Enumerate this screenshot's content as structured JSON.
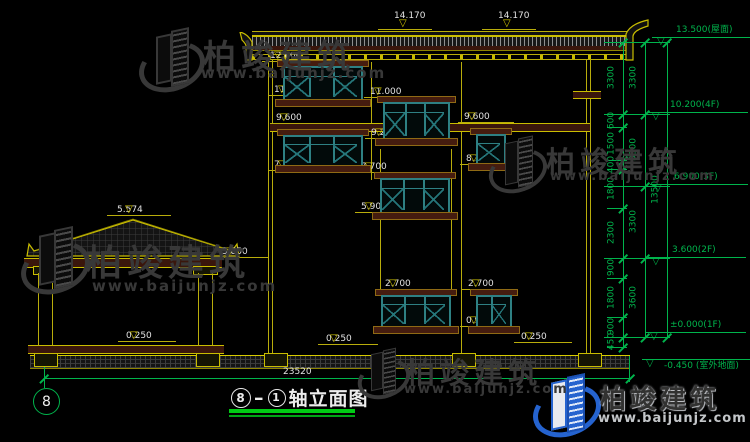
{
  "colors": {
    "background": "#000000",
    "structure_yellow": "#c9bd00",
    "dimension_green": "#00b44c",
    "label_white": "#e2e2e2",
    "window_teal": "#2e8083",
    "board_maroon": "#451c0f",
    "watermark_gray": "#383838",
    "logo_blue": "#2563cf",
    "underline_green": "#00cc14"
  },
  "title": {
    "axis_a": "8",
    "separator": "–",
    "axis_b": "1",
    "name": "轴立面图"
  },
  "axis_bubble": "8",
  "ground_dimension": "23520",
  "facade_markers": [
    {
      "text": "14.170"
    },
    {
      "text": "14.170"
    },
    {
      "text": "12.600"
    },
    {
      "text": "11.100"
    },
    {
      "text": "11.000"
    },
    {
      "text": "9.600"
    },
    {
      "text": "9.200"
    },
    {
      "text": "9.600"
    },
    {
      "text": "8.100"
    },
    {
      "text": "7.800"
    },
    {
      "text": "7.700"
    },
    {
      "text": "5.900"
    },
    {
      "text": "5.574"
    },
    {
      "text": "3.850"
    },
    {
      "text": "2.700"
    },
    {
      "text": "0.900"
    },
    {
      "text": "2.700"
    },
    {
      "text": "0.900"
    },
    {
      "text": "0.250"
    },
    {
      "text": "0.250"
    },
    {
      "text": "0.250"
    }
  ],
  "level_markers": [
    {
      "text": "13.500(屋面)"
    },
    {
      "text": "10.200(4F)"
    },
    {
      "text": "6.900(3F)"
    },
    {
      "text": "3.600(2F)"
    },
    {
      "text": "±0.000(1F)"
    },
    {
      "text": "-0.450 (室外地面)"
    }
  ],
  "dim_chains": {
    "inner": [
      "3300",
      "600",
      "1500",
      "400",
      "1800",
      "2300",
      "900",
      "1800",
      "900",
      "450"
    ],
    "floors": [
      "3300",
      "3300",
      "3300",
      "3600"
    ],
    "total": [
      "13500"
    ]
  },
  "watermark": {
    "brand": "柏竣建筑",
    "url": "www.baijunjz.com"
  },
  "logo": {
    "brand": "柏竣建筑",
    "url": "www.baijunjz.com"
  }
}
